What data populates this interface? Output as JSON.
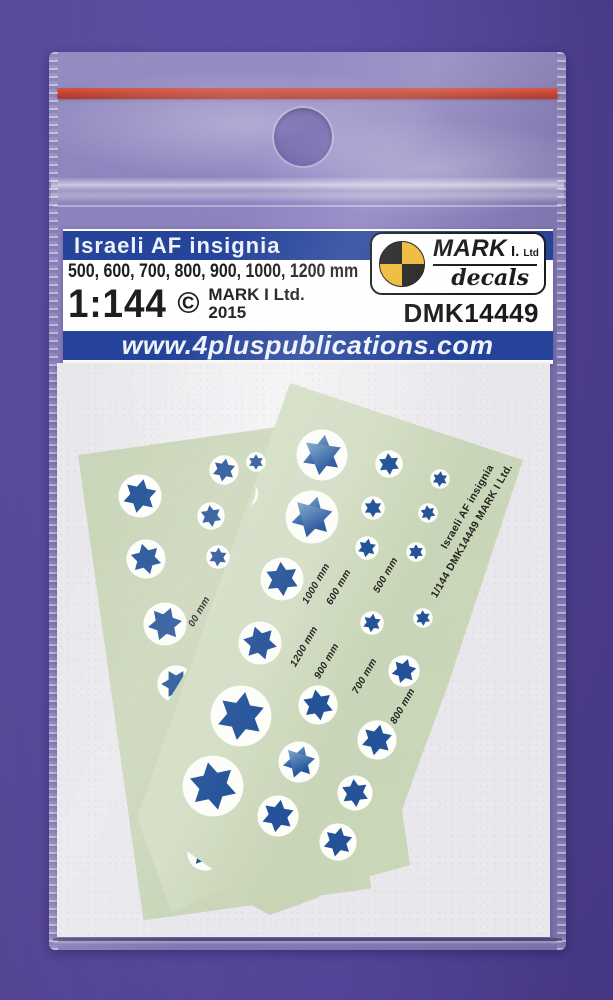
{
  "header": {
    "title": "Israeli AF insignia",
    "sizes_line": "500, 600, 700, 800, 900, 1000, 1200 mm",
    "scale": "1:144",
    "copyright_symbol": "©",
    "brand_line1": "MARK I Ltd.",
    "brand_line2": "2015",
    "product_code": "DMK14449",
    "website": "www.4pluspublications.com",
    "logo_brand": "MARK",
    "logo_suffix": "I.",
    "logo_ltd": "Ltd",
    "logo_sub": "decals"
  },
  "sheet": {
    "side_text_line1": "Israeli AF insignia",
    "side_text_line2": "1/144  DMK14449  MARK I Ltd.",
    "label_rotation_deg": -60,
    "size_labels": [
      {
        "text": "00 mm",
        "x": 196,
        "y": 630
      },
      {
        "text": "1000 mm",
        "x": 310,
        "y": 607
      },
      {
        "text": "600 mm",
        "x": 334,
        "y": 608
      },
      {
        "text": "500 mm",
        "x": 381,
        "y": 596
      },
      {
        "text": "1200 mm",
        "x": 298,
        "y": 670
      },
      {
        "text": "900 mm",
        "x": 322,
        "y": 682
      },
      {
        "text": "700 mm",
        "x": 360,
        "y": 697
      },
      {
        "text": "800 mm",
        "x": 398,
        "y": 727
      }
    ],
    "stars": [
      {
        "x": 224,
        "y": 470,
        "r": 15,
        "rot": 10
      },
      {
        "x": 256,
        "y": 462,
        "r": 10,
        "rot": 0
      },
      {
        "x": 322,
        "y": 455,
        "r": 26,
        "rot": 8,
        "hl": true
      },
      {
        "x": 389,
        "y": 464,
        "r": 14,
        "rot": -5
      },
      {
        "x": 440,
        "y": 479,
        "r": 10,
        "rot": 5
      },
      {
        "x": 140,
        "y": 496,
        "r": 22,
        "rot": 12
      },
      {
        "x": 211,
        "y": 516,
        "r": 14,
        "rot": -8
      },
      {
        "x": 312,
        "y": 517,
        "r": 27,
        "rot": 15,
        "hl": true
      },
      {
        "x": 373,
        "y": 508,
        "r": 12,
        "rot": 0
      },
      {
        "x": 428,
        "y": 513,
        "r": 10,
        "rot": -10
      },
      {
        "x": 146,
        "y": 559,
        "r": 20,
        "rot": -15
      },
      {
        "x": 218,
        "y": 557,
        "r": 12,
        "rot": 5
      },
      {
        "x": 282,
        "y": 579,
        "r": 22,
        "rot": -5
      },
      {
        "x": 367,
        "y": 548,
        "r": 12,
        "rot": 10
      },
      {
        "x": 416,
        "y": 552,
        "r": 10,
        "rot": 0
      },
      {
        "x": 165,
        "y": 624,
        "r": 22,
        "rot": 20
      },
      {
        "x": 176,
        "y": 684,
        "r": 19,
        "rot": -30,
        "clip": "half-left"
      },
      {
        "x": 260,
        "y": 643,
        "r": 22,
        "rot": -18
      },
      {
        "x": 372,
        "y": 623,
        "r": 12,
        "rot": 8
      },
      {
        "x": 423,
        "y": 618,
        "r": 10,
        "rot": -4
      },
      {
        "x": 241,
        "y": 716,
        "r": 31,
        "rot": 10
      },
      {
        "x": 318,
        "y": 705,
        "r": 20,
        "rot": -10
      },
      {
        "x": 404,
        "y": 671,
        "r": 16,
        "rot": 18
      },
      {
        "x": 213,
        "y": 786,
        "r": 31,
        "rot": -12
      },
      {
        "x": 299,
        "y": 762,
        "r": 21,
        "rot": 18,
        "hl": true
      },
      {
        "x": 377,
        "y": 740,
        "r": 20,
        "rot": 12
      },
      {
        "x": 278,
        "y": 816,
        "r": 21,
        "rot": 10
      },
      {
        "x": 355,
        "y": 793,
        "r": 18,
        "rot": -6
      },
      {
        "x": 338,
        "y": 842,
        "r": 19,
        "rot": 12
      },
      {
        "x": 205,
        "y": 853,
        "r": 18,
        "rot": 40,
        "clip": "sliver"
      }
    ]
  },
  "colors": {
    "background_purple": "#54459a",
    "banner_blue": "#1d3c96",
    "star_blue": "#1e4e96",
    "sheet_green": "#ccd8bb",
    "seal_red": "#c23b2b",
    "logo_yellow": "#f0b52c",
    "paper_white": "#e9e9ed"
  }
}
